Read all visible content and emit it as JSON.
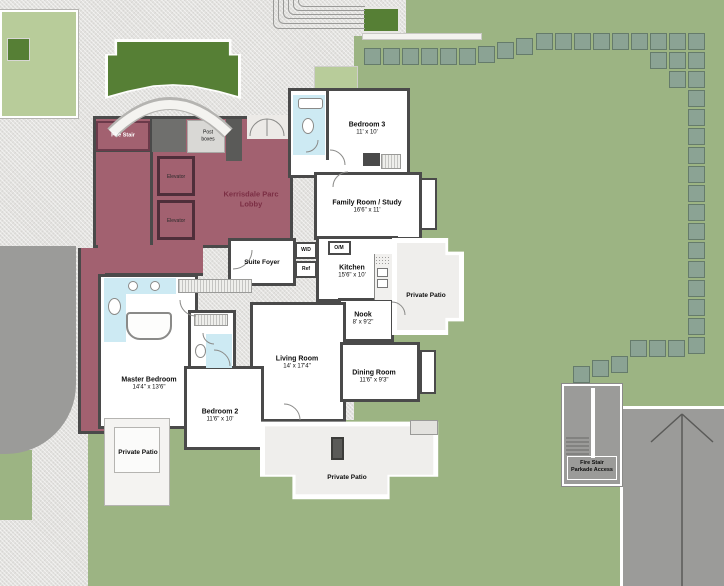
{
  "title": "Kerrisdale Parc floor plan",
  "colors": {
    "lawn": "#9cb483",
    "hedge": "#8ba394",
    "planter_green": "#567f35",
    "light_green": "#b8cc9a",
    "lobby_mauve": "#a26170",
    "lobby_text": "#7b2e44",
    "road_gray": "#9b9b99",
    "wall": "#4a4a4a",
    "bath_blue": "#cdeaf3"
  },
  "lobby": {
    "title_line1": "Kerrisdale Parc",
    "title_line2": "Lobby",
    "fire_stair": "Fire Stair",
    "post_boxes_line1": "Post",
    "post_boxes_line2": "boxes",
    "elevator_1": "Elevator",
    "elevator_2": "Elevator"
  },
  "suite": {
    "foyer": "Suite Foyer",
    "wd": "W/D",
    "ref": "Ref",
    "om": "O/M"
  },
  "rooms": [
    {
      "name": "Bedroom 3",
      "dims": "11' x 10'"
    },
    {
      "name": "Family Room / Study",
      "dims": "16'6\" x 11'"
    },
    {
      "name": "Kitchen",
      "dims": "15'6\" x 10'"
    },
    {
      "name": "Nook",
      "dims": "8' x 9'2\""
    },
    {
      "name": "Living Room",
      "dims": "14' x 17'4\""
    },
    {
      "name": "Dining Room",
      "dims": "11'6\" x 9'3\""
    },
    {
      "name": "Master Bedroom",
      "dims": "14'4\" x 13'6\""
    },
    {
      "name": "Bedroom 2",
      "dims": "11'6\" x 10'"
    }
  ],
  "patios": {
    "right": "Private Patio",
    "bottom_left": "Private Patio",
    "bottom_center": "Private Patio"
  },
  "parkade": {
    "line1": "Fire Stair",
    "line2": "Parkade Access"
  },
  "landscape": {
    "hedges": [
      [
        364,
        48
      ],
      [
        383,
        48
      ],
      [
        402,
        48
      ],
      [
        421,
        48
      ],
      [
        440,
        48
      ],
      [
        459,
        48
      ],
      [
        478,
        46
      ],
      [
        497,
        42
      ],
      [
        516,
        38
      ],
      [
        536,
        33
      ],
      [
        555,
        33
      ],
      [
        574,
        33
      ],
      [
        593,
        33
      ],
      [
        612,
        33
      ],
      [
        631,
        33
      ],
      [
        650,
        33
      ],
      [
        669,
        33
      ],
      [
        688,
        33
      ],
      [
        650,
        52
      ],
      [
        669,
        52
      ],
      [
        688,
        52
      ],
      [
        669,
        71
      ],
      [
        688,
        71
      ],
      [
        688,
        90
      ],
      [
        688,
        109
      ],
      [
        688,
        128
      ],
      [
        688,
        147
      ],
      [
        688,
        166
      ],
      [
        688,
        185
      ],
      [
        688,
        204
      ],
      [
        688,
        223
      ],
      [
        688,
        242
      ],
      [
        688,
        261
      ],
      [
        688,
        280
      ],
      [
        688,
        299
      ],
      [
        688,
        318
      ],
      [
        688,
        337
      ],
      [
        668,
        340
      ],
      [
        649,
        340
      ],
      [
        630,
        340
      ],
      [
        611,
        356
      ],
      [
        592,
        360
      ],
      [
        573,
        366
      ]
    ]
  }
}
